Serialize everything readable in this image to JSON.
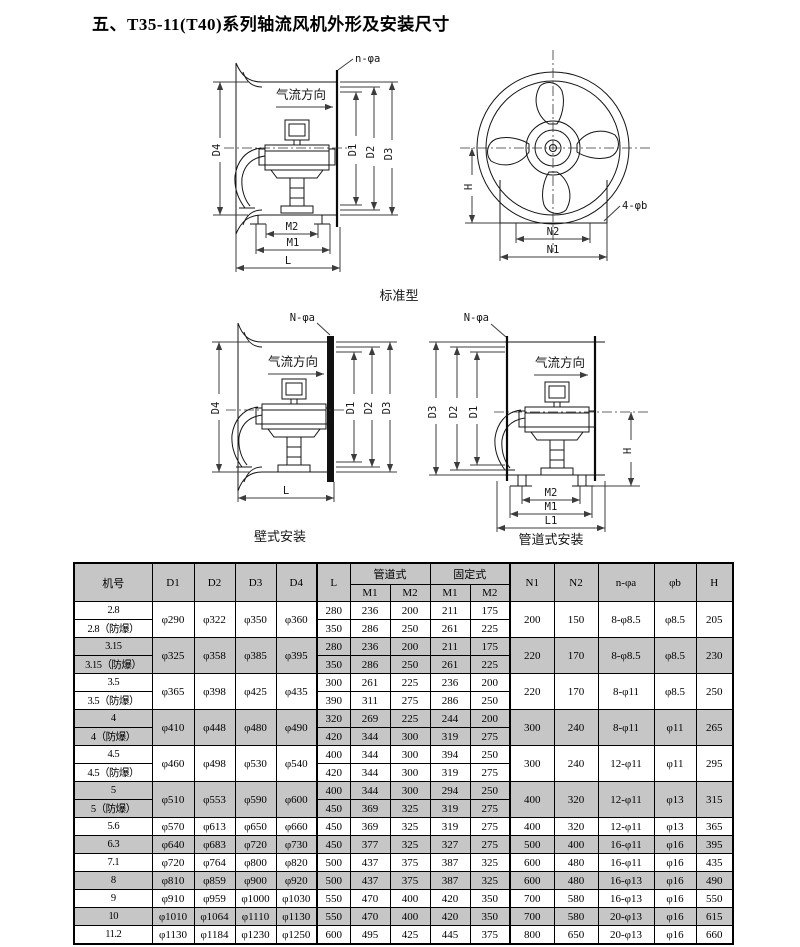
{
  "page": {
    "title": "五、T35-11(T40)系列轴流风机外形及安装尺寸"
  },
  "colors": {
    "row_shading": "#c6c6c6",
    "line": "#141414"
  },
  "diagrams": {
    "captions": {
      "standard": "标准型",
      "wall": "壁式安装",
      "duct": "管道式安装"
    },
    "airflow": "气流方向",
    "labels": {
      "n_phi_a_small": "n-φa",
      "n_phi_a_big": "N-φa",
      "four_phi_b": "4-φb",
      "d1": "D1",
      "d2": "D2",
      "d3": "D3",
      "d4": "D4",
      "m1": "M1",
      "m2": "M2",
      "l": "L",
      "l1": "L1",
      "n1": "N1",
      "n2": "N2",
      "h": "H"
    }
  },
  "table": {
    "headers": {
      "machine_no": "机号",
      "d1": "D1",
      "d2": "D2",
      "d3": "D3",
      "d4": "D4",
      "l": "L",
      "duct_type": "管道式",
      "fixed_type": "固定式",
      "m1": "M1",
      "m2": "M2",
      "n1": "N1",
      "n2": "N2",
      "n_phi_a": "n-φa",
      "phi_b": "φb",
      "h": "H"
    },
    "groups": [
      {
        "shaded": false,
        "d1": "φ290",
        "d2": "φ322",
        "d3": "φ350",
        "d4": "φ360",
        "n1": "200",
        "n2": "150",
        "n_phi_a": "8-φ8.5",
        "phi_b": "φ8.5",
        "h": "205",
        "rows": [
          {
            "label": "2.8",
            "l": "280",
            "duct_m1": "236",
            "duct_m2": "200",
            "fixed_m1": "211",
            "fixed_m2": "175"
          },
          {
            "label": "2.8（防爆）",
            "l": "350",
            "duct_m1": "286",
            "duct_m2": "250",
            "fixed_m1": "261",
            "fixed_m2": "225"
          }
        ]
      },
      {
        "shaded": true,
        "d1": "φ325",
        "d2": "φ358",
        "d3": "φ385",
        "d4": "φ395",
        "n1": "220",
        "n2": "170",
        "n_phi_a": "8-φ8.5",
        "phi_b": "φ8.5",
        "h": "230",
        "rows": [
          {
            "label": "3.15",
            "l": "280",
            "duct_m1": "236",
            "duct_m2": "200",
            "fixed_m1": "211",
            "fixed_m2": "175"
          },
          {
            "label": "3.15（防爆）",
            "l": "350",
            "duct_m1": "286",
            "duct_m2": "250",
            "fixed_m1": "261",
            "fixed_m2": "225"
          }
        ]
      },
      {
        "shaded": false,
        "d1": "φ365",
        "d2": "φ398",
        "d3": "φ425",
        "d4": "φ435",
        "n1": "220",
        "n2": "170",
        "n_phi_a": "8-φ11",
        "phi_b": "φ8.5",
        "h": "250",
        "rows": [
          {
            "label": "3.5",
            "l": "300",
            "duct_m1": "261",
            "duct_m2": "225",
            "fixed_m1": "236",
            "fixed_m2": "200"
          },
          {
            "label": "3.5（防爆）",
            "l": "390",
            "duct_m1": "311",
            "duct_m2": "275",
            "fixed_m1": "286",
            "fixed_m2": "250"
          }
        ]
      },
      {
        "shaded": true,
        "d1": "φ410",
        "d2": "φ448",
        "d3": "φ480",
        "d4": "φ490",
        "n1": "300",
        "n2": "240",
        "n_phi_a": "8-φ11",
        "phi_b": "φ11",
        "h": "265",
        "rows": [
          {
            "label": "4",
            "l": "320",
            "duct_m1": "269",
            "duct_m2": "225",
            "fixed_m1": "244",
            "fixed_m2": "200"
          },
          {
            "label": "4（防爆）",
            "l": "420",
            "duct_m1": "344",
            "duct_m2": "300",
            "fixed_m1": "319",
            "fixed_m2": "275"
          }
        ]
      },
      {
        "shaded": false,
        "d1": "φ460",
        "d2": "φ498",
        "d3": "φ530",
        "d4": "φ540",
        "n1": "300",
        "n2": "240",
        "n_phi_a": "12-φ11",
        "phi_b": "φ11",
        "h": "295",
        "rows": [
          {
            "label": "4.5",
            "l": "400",
            "duct_m1": "344",
            "duct_m2": "300",
            "fixed_m1": "394",
            "fixed_m2": "250"
          },
          {
            "label": "4.5（防爆）",
            "l": "420",
            "duct_m1": "344",
            "duct_m2": "300",
            "fixed_m1": "319",
            "fixed_m2": "275"
          }
        ]
      },
      {
        "shaded": true,
        "d1": "φ510",
        "d2": "φ553",
        "d3": "φ590",
        "d4": "φ600",
        "n1": "400",
        "n2": "320",
        "n_phi_a": "12-φ11",
        "phi_b": "φ13",
        "h": "315",
        "rows": [
          {
            "label": "5",
            "l": "400",
            "duct_m1": "344",
            "duct_m2": "300",
            "fixed_m1": "294",
            "fixed_m2": "250"
          },
          {
            "label": "5（防爆）",
            "l": "450",
            "duct_m1": "369",
            "duct_m2": "325",
            "fixed_m1": "319",
            "fixed_m2": "275"
          }
        ]
      },
      {
        "shaded": false,
        "d1": "φ570",
        "d2": "φ613",
        "d3": "φ650",
        "d4": "φ660",
        "n1": "400",
        "n2": "320",
        "n_phi_a": "12-φ11",
        "phi_b": "φ13",
        "h": "365",
        "rows": [
          {
            "label": "5.6",
            "l": "450",
            "duct_m1": "369",
            "duct_m2": "325",
            "fixed_m1": "319",
            "fixed_m2": "275"
          }
        ]
      },
      {
        "shaded": true,
        "d1": "φ640",
        "d2": "φ683",
        "d3": "φ720",
        "d4": "φ730",
        "n1": "500",
        "n2": "400",
        "n_phi_a": "16-φ11",
        "phi_b": "φ16",
        "h": "395",
        "rows": [
          {
            "label": "6.3",
            "l": "450",
            "duct_m1": "377",
            "duct_m2": "325",
            "fixed_m1": "327",
            "fixed_m2": "275"
          }
        ]
      },
      {
        "shaded": false,
        "d1": "φ720",
        "d2": "φ764",
        "d3": "φ800",
        "d4": "φ820",
        "n1": "600",
        "n2": "480",
        "n_phi_a": "16-φ11",
        "phi_b": "φ16",
        "h": "435",
        "rows": [
          {
            "label": "7.1",
            "l": "500",
            "duct_m1": "437",
            "duct_m2": "375",
            "fixed_m1": "387",
            "fixed_m2": "325"
          }
        ]
      },
      {
        "shaded": true,
        "d1": "φ810",
        "d2": "φ859",
        "d3": "φ900",
        "d4": "φ920",
        "n1": "600",
        "n2": "480",
        "n_phi_a": "16-φ13",
        "phi_b": "φ16",
        "h": "490",
        "rows": [
          {
            "label": "8",
            "l": "500",
            "duct_m1": "437",
            "duct_m2": "375",
            "fixed_m1": "387",
            "fixed_m2": "325"
          }
        ]
      },
      {
        "shaded": false,
        "d1": "φ910",
        "d2": "φ959",
        "d3": "φ1000",
        "d4": "φ1030",
        "n1": "700",
        "n2": "580",
        "n_phi_a": "16-φ13",
        "phi_b": "φ16",
        "h": "550",
        "rows": [
          {
            "label": "9",
            "l": "550",
            "duct_m1": "470",
            "duct_m2": "400",
            "fixed_m1": "420",
            "fixed_m2": "350"
          }
        ]
      },
      {
        "shaded": true,
        "d1": "φ1010",
        "d2": "φ1064",
        "d3": "φ1110",
        "d4": "φ1130",
        "n1": "700",
        "n2": "580",
        "n_phi_a": "20-φ13",
        "phi_b": "φ16",
        "h": "615",
        "rows": [
          {
            "label": "10",
            "l": "550",
            "duct_m1": "470",
            "duct_m2": "400",
            "fixed_m1": "420",
            "fixed_m2": "350"
          }
        ]
      },
      {
        "shaded": false,
        "d1": "φ1130",
        "d2": "φ1184",
        "d3": "φ1230",
        "d4": "φ1250",
        "n1": "800",
        "n2": "650",
        "n_phi_a": "20-φ13",
        "phi_b": "φ16",
        "h": "660",
        "rows": [
          {
            "label": "11.2",
            "l": "600",
            "duct_m1": "495",
            "duct_m2": "425",
            "fixed_m1": "445",
            "fixed_m2": "375"
          }
        ]
      }
    ]
  }
}
